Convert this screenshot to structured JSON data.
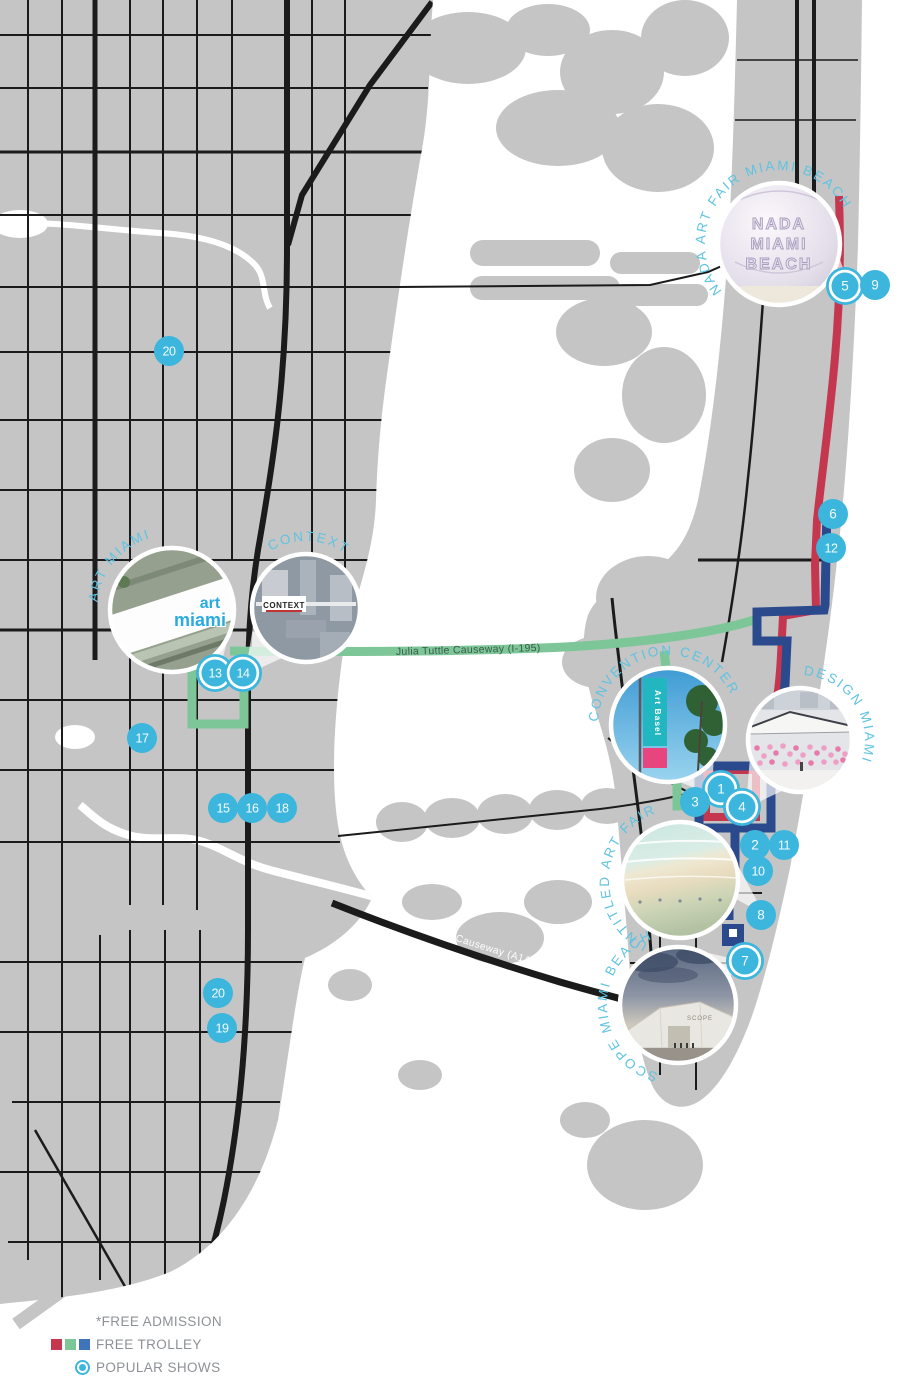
{
  "map": {
    "colors": {
      "land": "#c5c5c5",
      "water": "#ffffff",
      "road": "#1b1b1b",
      "route_red": "#c4374f",
      "route_green": "#7dc698",
      "route_blue": "#2b4a8d",
      "legend_blue": "#3f74ba",
      "marker": "#3cb6dc",
      "venue_label": "#5fc3e1",
      "legend_text": "#8d9195"
    },
    "road_labels": {
      "julia_tuttle": "Julia Tuttle Causeway (I-195)",
      "macarthur": "MacArthur Causeway (A1A)"
    },
    "legend": {
      "free_admission": "*FREE ADMISSION",
      "free_trolley": "FREE TROLLEY",
      "popular_shows": "POPULAR SHOWS"
    },
    "markers": [
      {
        "n": "1",
        "x": 721,
        "y": 789,
        "popular": true
      },
      {
        "n": "2",
        "x": 755,
        "y": 845,
        "popular": false
      },
      {
        "n": "3",
        "x": 695,
        "y": 802,
        "popular": false
      },
      {
        "n": "4",
        "x": 742,
        "y": 807,
        "popular": true
      },
      {
        "n": "5",
        "x": 845,
        "y": 286,
        "popular": true
      },
      {
        "n": "6",
        "x": 833,
        "y": 514,
        "popular": false
      },
      {
        "n": "7",
        "x": 745,
        "y": 961,
        "popular": true
      },
      {
        "n": "8",
        "x": 761,
        "y": 915,
        "popular": false
      },
      {
        "n": "9",
        "x": 875,
        "y": 285,
        "popular": false
      },
      {
        "n": "10",
        "x": 758,
        "y": 871,
        "popular": false
      },
      {
        "n": "11",
        "x": 784,
        "y": 845,
        "popular": false
      },
      {
        "n": "12",
        "x": 831,
        "y": 548,
        "popular": false
      },
      {
        "n": "13",
        "x": 215,
        "y": 673,
        "popular": true
      },
      {
        "n": "14",
        "x": 243,
        "y": 673,
        "popular": true
      },
      {
        "n": "15",
        "x": 223,
        "y": 808,
        "popular": false
      },
      {
        "n": "16",
        "x": 252,
        "y": 808,
        "popular": false
      },
      {
        "n": "17",
        "x": 142,
        "y": 738,
        "popular": false
      },
      {
        "n": "18",
        "x": 282,
        "y": 808,
        "popular": false
      },
      {
        "n": "19",
        "x": 222,
        "y": 1028,
        "popular": false
      },
      {
        "n": "20",
        "x": 169,
        "y": 351,
        "popular": false
      },
      {
        "n": "20",
        "x": 218,
        "y": 993,
        "popular": false
      }
    ],
    "venues": [
      {
        "id": "art-miami",
        "label": "ART MIAMI",
        "x": 172,
        "y": 610,
        "r": 62,
        "logo": "art miami"
      },
      {
        "id": "context",
        "label": "CONTEXT",
        "x": 306,
        "y": 608,
        "r": 54,
        "logo": "CONTEXT"
      },
      {
        "id": "nada",
        "label": "NADA ART FAIR MIAMI BEACH",
        "x": 779,
        "y": 244,
        "r": 61,
        "logo": "NADA MIAMI BEACH"
      },
      {
        "id": "convention-center",
        "label": "CONVENTION CENTER",
        "x": 668,
        "y": 725,
        "r": 57,
        "logo": "Art Basel"
      },
      {
        "id": "design-miami",
        "label": "DESIGN MIAMI",
        "x": 800,
        "y": 740,
        "r": 52,
        "logo": ""
      },
      {
        "id": "untitled",
        "label": "UNTITLED ART FAIR",
        "x": 680,
        "y": 880,
        "r": 58,
        "logo": ""
      },
      {
        "id": "scope",
        "label": "SCOPE MIAMI BEACH",
        "x": 678,
        "y": 1005,
        "r": 58,
        "logo": "SCOPE"
      }
    ]
  }
}
